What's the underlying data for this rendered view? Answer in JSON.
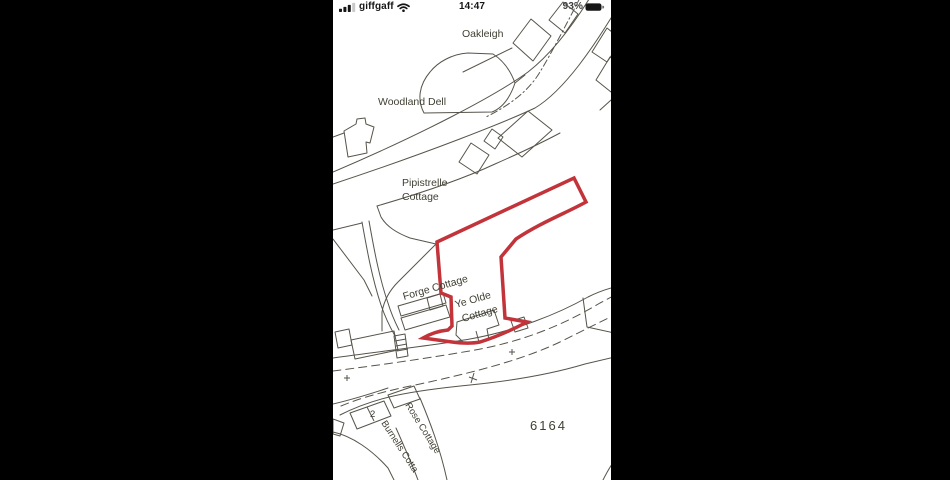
{
  "status_bar": {
    "carrier": "giffgaff",
    "time": "14:47",
    "battery": "93%",
    "icons": {
      "signal": "cellular-signal",
      "wifi": "wifi",
      "battery": "battery"
    }
  },
  "map": {
    "labels": {
      "oakleigh": "Oakleigh",
      "woodland_dell": "Woodland Dell",
      "pipistrelle_1": "Pipistrelle",
      "pipistrelle_2": "Cottage",
      "forge": "Forge Cottage",
      "ye_olde_1": "Ye Olde",
      "ye_olde_2": "Cottage",
      "parcel_number": "6164",
      "house_number": "2",
      "rose": "Rose Cottage",
      "burnells": "Burnells Cotta"
    },
    "colors": {
      "plot_outline": "#c2333a",
      "map_line": "#56544a",
      "map_text": "#403f33",
      "background": "#ffffff",
      "letterbox": "#000000"
    }
  }
}
